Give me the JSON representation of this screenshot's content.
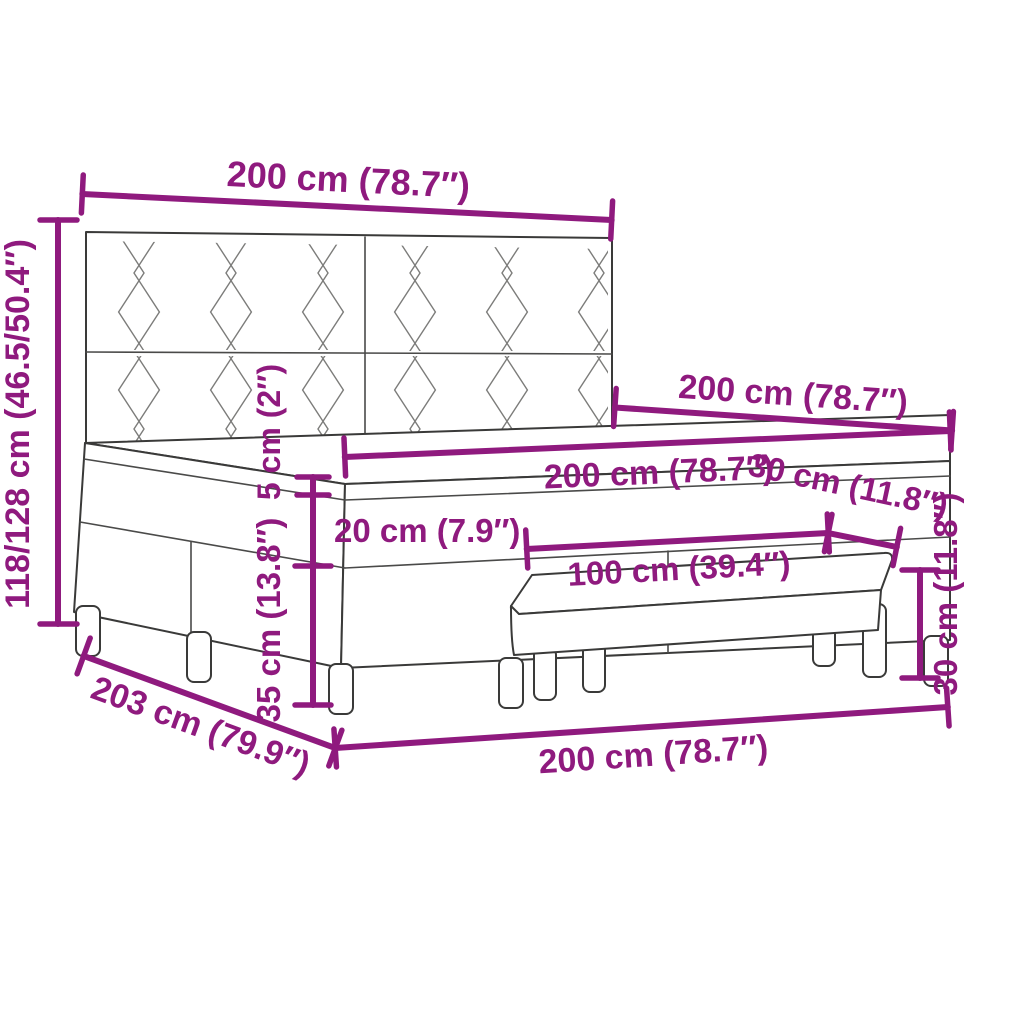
{
  "diagram": {
    "type": "product-dimension-diagram",
    "subject": "box spring bed with patterned headboard, mattress, topper and bench",
    "background_color": "#FFFFFF",
    "dimension_color": "#8F1A7E",
    "line_art_color": "#3A3A39",
    "dims": [
      {
        "id": "headboard-width",
        "label": "200 cm (78.7″)"
      },
      {
        "id": "headboard-height",
        "label": "118/128 cm (46.5/50.4″)"
      },
      {
        "id": "bed-length-top",
        "label": "200 cm (78.7″)"
      },
      {
        "id": "mattress-width",
        "label": "200 cm (78.7″)"
      },
      {
        "id": "topper-thickness",
        "label": "5 cm (2″)"
      },
      {
        "id": "mattress-thickness",
        "label": "20 cm (7.9″)"
      },
      {
        "id": "bench-depth",
        "label": "30 cm (11.8″)"
      },
      {
        "id": "bench-length",
        "label": "100 cm (39.4″)"
      },
      {
        "id": "base-height",
        "label": "35 cm (13.8″)"
      },
      {
        "id": "bench-height",
        "label": "30 cm (11.8″)"
      },
      {
        "id": "total-length",
        "label": "203 cm (79.9″)"
      },
      {
        "id": "bed-width-bottom",
        "label": "200 cm (78.7″)"
      }
    ]
  }
}
